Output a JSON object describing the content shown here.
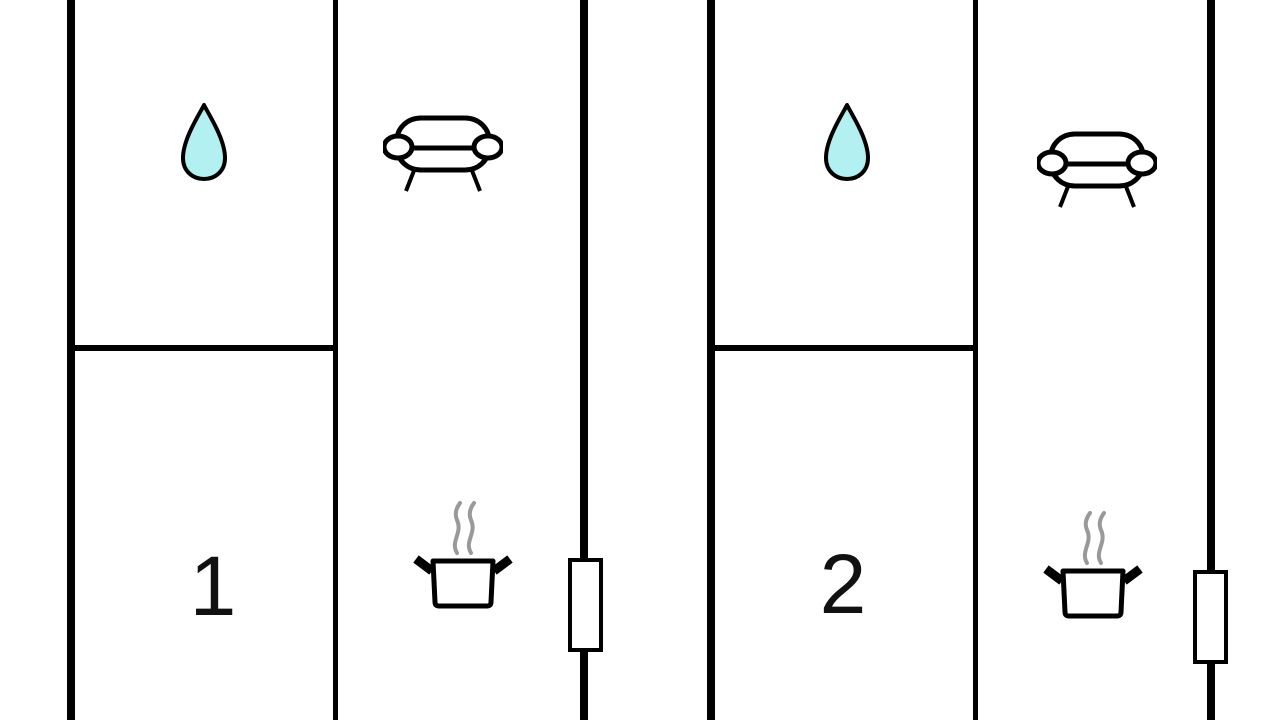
{
  "diagram": {
    "type": "floor-plan",
    "units": [
      {
        "label": "1",
        "rooms": [
          {
            "name": "bathroom",
            "icon": "water-drop-icon"
          },
          {
            "name": "room-1",
            "text": "1"
          },
          {
            "name": "living-room",
            "icon": "sofa-icon"
          },
          {
            "name": "kitchen",
            "icon": "cooking-pot-icon"
          }
        ],
        "features": [
          "window-icon"
        ]
      },
      {
        "label": "2",
        "rooms": [
          {
            "name": "bathroom",
            "icon": "water-drop-icon"
          },
          {
            "name": "room-2",
            "text": "2"
          },
          {
            "name": "living-room",
            "icon": "sofa-icon"
          },
          {
            "name": "kitchen",
            "icon": "cooking-pot-icon"
          }
        ],
        "features": [
          "window-icon"
        ]
      }
    ],
    "colors": {
      "wall": "#000000",
      "drop_fill": "#b2f0f1",
      "drop_stroke": "#000000",
      "steam": "#999999",
      "label": "#111111",
      "background": "#ffffff"
    }
  }
}
